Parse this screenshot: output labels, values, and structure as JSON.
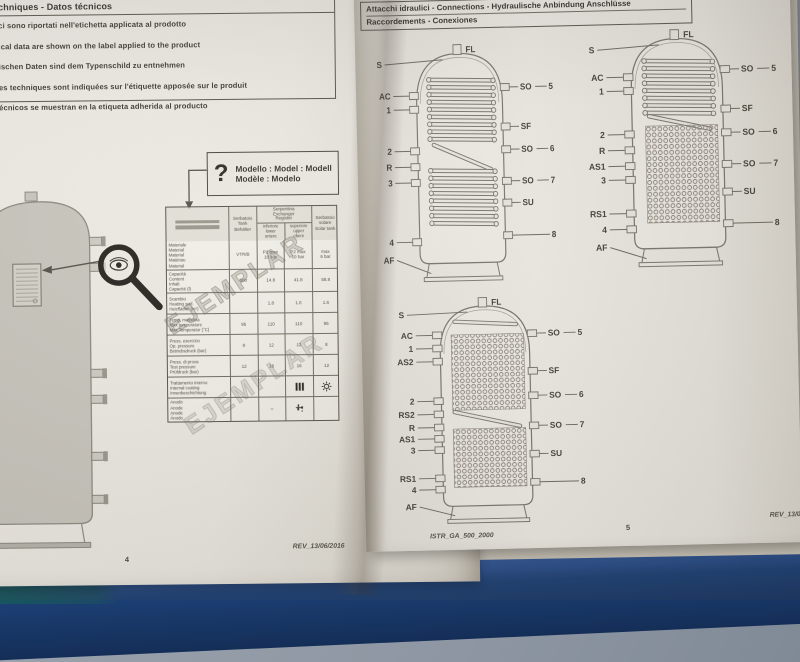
{
  "scene": {
    "backdrop_color": "#8d96a2",
    "table_surface_color": "#1c3f74",
    "table_surface_teal_color": "#17565e",
    "page_color": "#ebe8e1"
  },
  "left_page": {
    "header": {
      "line1": "Technical data - Technische Daten",
      "line2": "chniques - Datos técnicos"
    },
    "notes": [
      "ci sono riportati nell'etichetta applicata al prodotto",
      "ical data are shown on the label applied to the product",
      "ischen Daten sind dem Typenschild zu entnehmen",
      "es techniques sont indiquées sur l'étiquette apposée sur le produit",
      "écnicos se muestran en la etiqueta adherida al producto"
    ],
    "model_box": {
      "icon": "question-mark",
      "line1": "Modello : Model : Modell",
      "line2": "Modèle : Modelo"
    },
    "magnifier": {
      "icon": "eye-magnifier-icon"
    },
    "watermark": "EJEMPLAR",
    "table": {
      "header": {
        "tank": "Serbatoio\nTank\nBehälter",
        "exchanger_group": "Serpentina\nExchanger\nRegister",
        "exchanger_lower": "inferiore\nlower\nuntere",
        "exchanger_upper": "superiore\nupper\nobere",
        "solar": "Serbatoio\nsolare\nSolar tank"
      },
      "rows": [
        {
          "label": "Materiale\nMaterial\nMaterial\nMatériau\nMaterial",
          "cells": [
            "VTR/B",
            "P2 max\n10 bar",
            "P2 max\n10 bar",
            "max\n6 bar"
          ]
        },
        {
          "label": "Capacità\nContent\nInhalt\nCapacité (l)",
          "cells": [
            "500",
            "14.8",
            "41.8",
            "58.8"
          ]
        },
        {
          "label": "Scambio\nHeating surf.\nHeizfläche (m²)",
          "cells": [
            "",
            "1.8",
            "1.0",
            "1.6"
          ]
        },
        {
          "label": "Temp. massima\nMax temperature\nMax Temperatur (°C)",
          "cells": [
            "95",
            "110",
            "110",
            "95"
          ]
        },
        {
          "label": "Press. esercizio\nOp. pressure\nBetriebsdruck (bar)",
          "cells": [
            "8",
            "12",
            "12",
            "8"
          ]
        },
        {
          "label": "Press. di prova\nTest pressure\nPrüfdruck (bar)",
          "cells": [
            "12",
            "16",
            "16",
            "12"
          ]
        },
        {
          "label": "Trattamento interno\nInternal coating\nInnenbeschichtung",
          "cells": [
            "",
            "",
            "icon:heating-element",
            "icon:sun"
          ]
        },
        {
          "label": "Anodo\nAnode\nAnode\nÁnodo",
          "cells": [
            "",
            "○",
            "icon:faucet",
            ""
          ]
        }
      ]
    },
    "footer": {
      "rev": "REV_13/06/2016",
      "page_number": "4"
    }
  },
  "right_page": {
    "header": {
      "line1": "Attacchi idraulici - Connections - Hydraulische Anbindung Anschlüsse",
      "line2": "Raccordements - Conexiones"
    },
    "diagrams": [
      {
        "name": "tank-two-coils",
        "top_label": "FL",
        "exchanger": "double-coil",
        "left_labels": [
          {
            "t": "S",
            "y": 30
          },
          {
            "t": "AC",
            "y": 62
          },
          {
            "t": "1",
            "y": 76
          },
          {
            "t": "2",
            "y": 118
          },
          {
            "t": "R",
            "y": 134
          },
          {
            "t": "3",
            "y": 150
          },
          {
            "t": "4",
            "y": 210
          },
          {
            "t": "AF",
            "y": 228
          }
        ],
        "right_labels": [
          {
            "t": "SO",
            "y": 55,
            "out": "5"
          },
          {
            "t": "SF",
            "y": 95
          },
          {
            "t": "SO",
            "y": 118,
            "out": "6"
          },
          {
            "t": "SO",
            "y": 150,
            "out": "7"
          },
          {
            "t": "SU",
            "y": 172
          },
          {
            "t": "",
            "y": 205,
            "out": "8"
          }
        ]
      },
      {
        "name": "tank-coil-and-corrugated",
        "top_label": "FL",
        "exchanger": "coil-and-corrugated",
        "left_labels": [
          {
            "t": "S",
            "y": 30
          },
          {
            "t": "AC",
            "y": 58
          },
          {
            "t": "1",
            "y": 72
          },
          {
            "t": "2",
            "y": 116
          },
          {
            "t": "R",
            "y": 132
          },
          {
            "t": "AS1",
            "y": 148
          },
          {
            "t": "3",
            "y": 162
          },
          {
            "t": "RS1",
            "y": 196
          },
          {
            "t": "4",
            "y": 212
          },
          {
            "t": "AF",
            "y": 230
          }
        ],
        "right_labels": [
          {
            "t": "SO",
            "y": 52,
            "out": "5"
          },
          {
            "t": "SF",
            "y": 92
          },
          {
            "t": "SO",
            "y": 116,
            "out": "6"
          },
          {
            "t": "SO",
            "y": 148,
            "out": "7"
          },
          {
            "t": "SU",
            "y": 176
          },
          {
            "t": "",
            "y": 208,
            "out": "8"
          }
        ]
      },
      {
        "name": "tank-double-corrugated",
        "top_label": "FL",
        "exchanger": "double-corrugated",
        "left_labels": [
          {
            "t": "S",
            "y": 28
          },
          {
            "t": "AC",
            "y": 50
          },
          {
            "t": "1",
            "y": 64
          },
          {
            "t": "AS2",
            "y": 78
          },
          {
            "t": "2",
            "y": 120
          },
          {
            "t": "RS2",
            "y": 134
          },
          {
            "t": "R",
            "y": 148
          },
          {
            "t": "AS1",
            "y": 160
          },
          {
            "t": "3",
            "y": 172
          },
          {
            "t": "RS1",
            "y": 202
          },
          {
            "t": "4",
            "y": 214
          },
          {
            "t": "AF",
            "y": 232
          }
        ],
        "right_labels": [
          {
            "t": "SO",
            "y": 50,
            "out": "5"
          },
          {
            "t": "SF",
            "y": 90
          },
          {
            "t": "SO",
            "y": 116,
            "out": "6"
          },
          {
            "t": "SO",
            "y": 148,
            "out": "7"
          },
          {
            "t": "SU",
            "y": 178
          },
          {
            "t": "",
            "y": 208,
            "out": "8"
          }
        ]
      }
    ],
    "footer": {
      "doc_code": "ISTR_GA_500_2000",
      "page_number": "5",
      "rev": "REV_13/06/2016"
    }
  }
}
